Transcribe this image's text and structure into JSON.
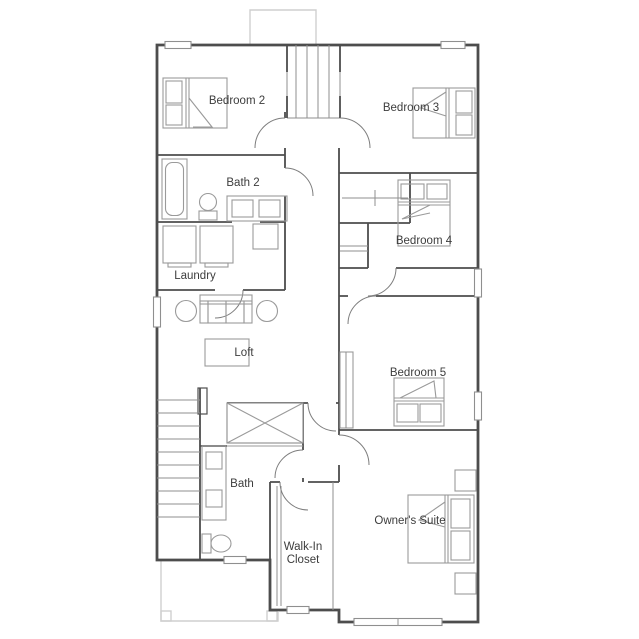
{
  "plan": {
    "rooms": [
      {
        "id": "bedroom2",
        "label": "Bedroom 2"
      },
      {
        "id": "bedroom3",
        "label": "Bedroom 3"
      },
      {
        "id": "bath2",
        "label": "Bath 2"
      },
      {
        "id": "bedroom4",
        "label": "Bedroom 4"
      },
      {
        "id": "laundry",
        "label": "Laundry"
      },
      {
        "id": "loft",
        "label": "Loft"
      },
      {
        "id": "bedroom5",
        "label": "Bedroom 5"
      },
      {
        "id": "bath",
        "label": "Bath"
      },
      {
        "id": "walkin",
        "label_lines": [
          "Walk-In",
          "Closet"
        ]
      },
      {
        "id": "owners",
        "label": "Owner's Suite"
      }
    ],
    "colors": {
      "wall": "#4d4d4d",
      "furniture": "#9a9a9a",
      "light_outline": "#cfcfcf",
      "background": "#ffffff",
      "text": "#3d3d3d"
    }
  }
}
